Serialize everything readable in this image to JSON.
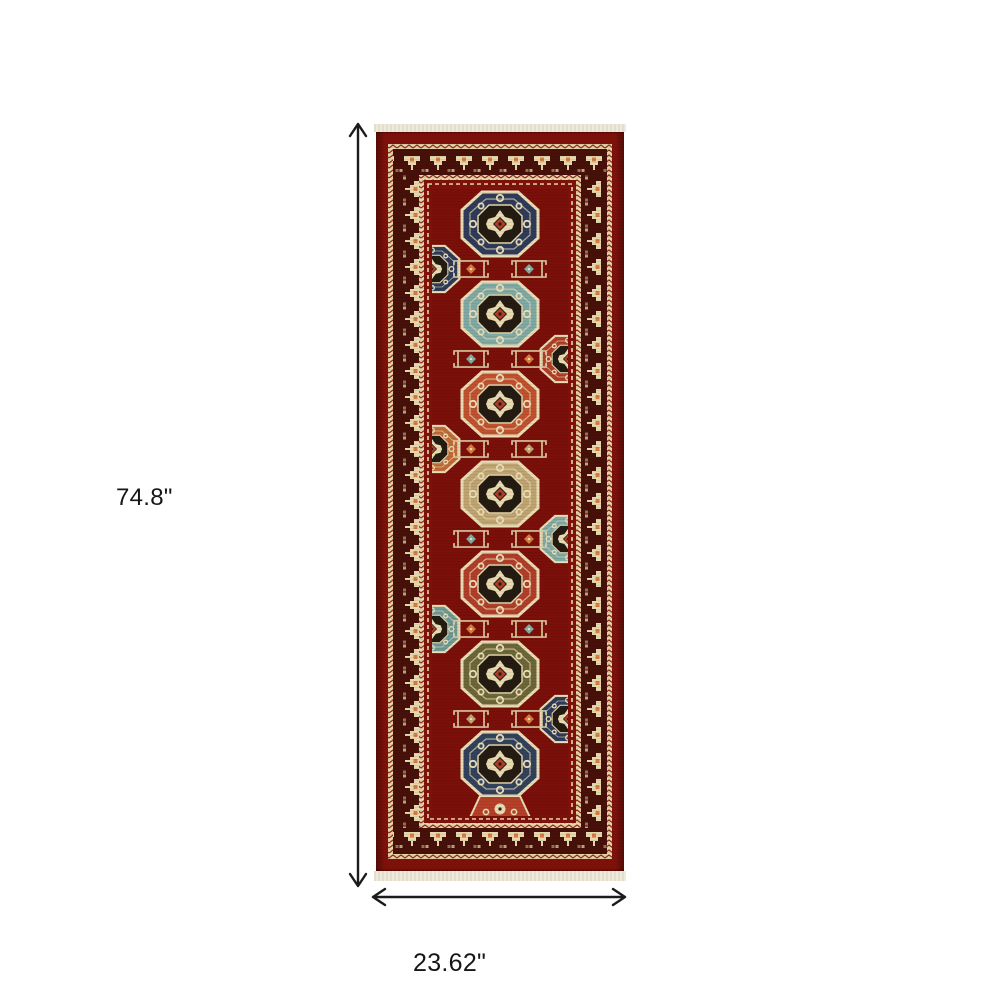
{
  "canvas": {
    "width": 1000,
    "height": 1000,
    "background": "#ffffff"
  },
  "annotations": {
    "height_label": "74.8\"",
    "width_label": "23.62\"",
    "arrow_color": "#1b1b1b",
    "label_color": "#161616"
  },
  "rug": {
    "description": "red oriental kazak-style runner rug with column of octagon medallions, geometric crown-motif borders and cream fringe at both ends",
    "palette": {
      "field_red": "#7E120B",
      "outer_band_red": "#811309",
      "border_dark": "#47110A",
      "cream": "#E8DBB2",
      "guard_cream": "#E4D5AC",
      "rust_orange": "#C05230",
      "terracotta": "#B03E28",
      "teal": "#7FA9A4",
      "navy": "#2F3B58",
      "olive": "#6C6638",
      "tan": "#BFA370",
      "fringe": "#EFEADC"
    },
    "medallion_colors": [
      "#2F3B58",
      "#7FA9A4",
      "#C05230",
      "#BFA370",
      "#B03E28",
      "#6C6638",
      "#32415C"
    ]
  }
}
